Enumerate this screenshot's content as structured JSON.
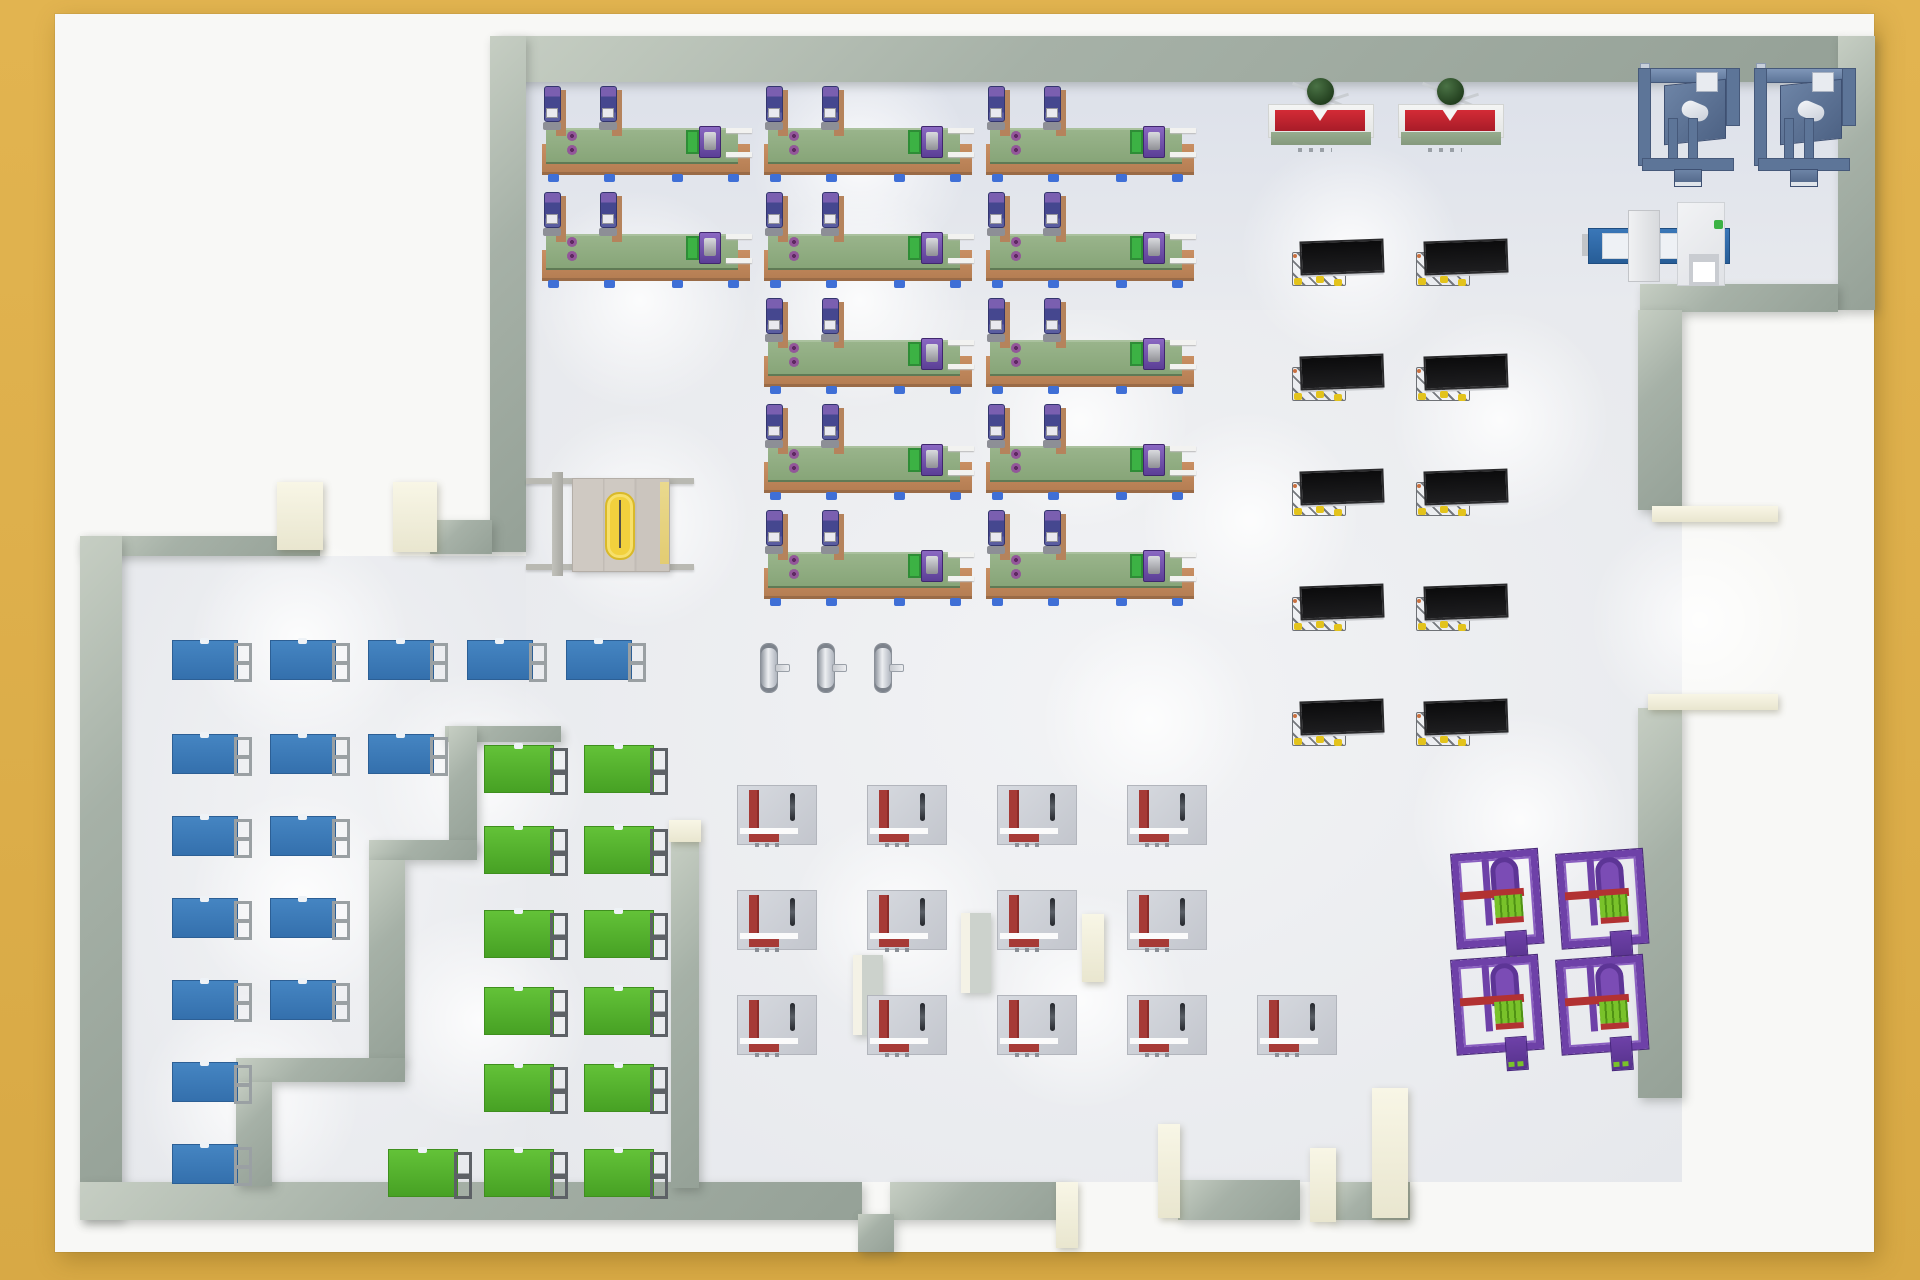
{
  "scene": {
    "description": "Top-down 3D render of a factory floor plan",
    "background_color": "#dcae4b",
    "page_color": "#f8f8f6",
    "floor_color": "#e9ebef",
    "wall_color": "#a6b1a7",
    "pillar_color": "#f0eedb"
  },
  "colors": {
    "conveyor_base": "#c0885c",
    "conveyor_belt": "#8fac80",
    "robot_purple": "#6a55a5",
    "desk_blue": "#3979b7",
    "desk_green": "#54b12d",
    "bench_gray": "#cdd0d6",
    "bench_red": "#a63a36",
    "monitor_black": "#161616",
    "monitor_yellow": "#e3c31c",
    "cell_purple": "#6e41a8",
    "cell_green": "#79c22a",
    "balancer_red": "#c32531",
    "sphere_green": "#2e4d2a",
    "gantry_steel": "#5d7598",
    "cmm_blue": "#2e69a9",
    "portal_yellow": "#f2d13d",
    "cylinder_silver": "#c8ccd3"
  },
  "floor_rects": [
    [
      526,
      82,
      1312,
      228
    ],
    [
      526,
      310,
      1156,
      872
    ],
    [
      122,
      556,
      404,
      626
    ]
  ],
  "lights": [
    [
      640,
      300
    ],
    [
      860,
      300
    ],
    [
      640,
      520
    ],
    [
      1080,
      420
    ],
    [
      300,
      640
    ],
    [
      480,
      780
    ],
    [
      300,
      900
    ],
    [
      480,
      1020
    ],
    [
      860,
      160
    ],
    [
      1250,
      520
    ],
    [
      1150,
      720
    ],
    [
      900,
      920
    ],
    [
      1500,
      420
    ],
    [
      1520,
      820
    ],
    [
      1700,
      620
    ],
    [
      1080,
      1000
    ],
    [
      250,
      1100
    ],
    [
      1350,
      250
    ]
  ],
  "walls": [
    [
      497,
      36,
      1341,
      46
    ],
    [
      1838,
      36,
      37,
      274
    ],
    [
      1640,
      284,
      198,
      28
    ],
    [
      490,
      36,
      36,
      516
    ],
    [
      430,
      520,
      62,
      34
    ],
    [
      80,
      536,
      240,
      20
    ],
    [
      80,
      536,
      42,
      684
    ],
    [
      80,
      1182,
      782,
      38
    ],
    [
      890,
      1182,
      176,
      38
    ],
    [
      1178,
      1180,
      122,
      40
    ],
    [
      1332,
      1182,
      78,
      38
    ],
    [
      858,
      1214,
      36,
      38
    ],
    [
      1638,
      310,
      44,
      200
    ],
    [
      1638,
      708,
      44,
      390
    ],
    [
      445,
      726,
      116,
      16
    ],
    [
      449,
      726,
      28,
      124
    ],
    [
      369,
      840,
      108,
      20
    ],
    [
      369,
      860,
      36,
      202
    ],
    [
      236,
      1058,
      169,
      24
    ],
    [
      236,
      1082,
      36,
      104
    ],
    [
      671,
      840,
      28,
      348
    ]
  ],
  "cream_blocks": [
    [
      277,
      482,
      46,
      68
    ],
    [
      393,
      482,
      44,
      70
    ],
    [
      1652,
      506,
      126,
      16
    ],
    [
      1648,
      694,
      130,
      16
    ],
    [
      669,
      820,
      32,
      22
    ],
    [
      1372,
      1088,
      36,
      130
    ],
    [
      1158,
      1124,
      22,
      94
    ],
    [
      1310,
      1148,
      26,
      74
    ],
    [
      1056,
      1182,
      22,
      66
    ],
    [
      1082,
      914,
      22,
      68
    ]
  ],
  "wall_stubs": [
    [
      853,
      955,
      30,
      80
    ],
    [
      961,
      913,
      30,
      80
    ]
  ],
  "equipment": {
    "conveyor_lines": {
      "unit_width": 212,
      "unit_height": 104,
      "robot_offsets": [
        2,
        58
      ],
      "rows": [
        {
          "belt_y": 128,
          "xs": [
            540,
            762,
            984
          ]
        },
        {
          "belt_y": 234,
          "xs": [
            540,
            762,
            984
          ]
        },
        {
          "belt_y": 340,
          "xs": [
            762,
            984
          ]
        },
        {
          "belt_y": 446,
          "xs": [
            762,
            984
          ]
        },
        {
          "belt_y": 552,
          "xs": [
            762,
            984
          ]
        }
      ]
    },
    "blue_desks": {
      "rows": [
        {
          "y": 640,
          "xs": [
            172,
            270,
            368,
            467,
            566
          ]
        },
        {
          "y": 734,
          "xs": [
            172,
            270,
            368
          ]
        },
        {
          "y": 816,
          "xs": [
            172,
            270
          ]
        },
        {
          "y": 898,
          "xs": [
            172,
            270
          ]
        },
        {
          "y": 980,
          "xs": [
            172,
            270
          ]
        },
        {
          "y": 1062,
          "xs": [
            172
          ]
        },
        {
          "y": 1144,
          "xs": [
            172
          ]
        }
      ]
    },
    "green_desks": {
      "rows": [
        {
          "y": 745,
          "xs": [
            484,
            584
          ]
        },
        {
          "y": 826,
          "xs": [
            484,
            584
          ]
        },
        {
          "y": 910,
          "xs": [
            484,
            584
          ]
        },
        {
          "y": 987,
          "xs": [
            484,
            584
          ]
        },
        {
          "y": 1064,
          "xs": [
            484,
            584
          ]
        },
        {
          "y": 1149,
          "xs": [
            388,
            484,
            584
          ]
        }
      ]
    },
    "gray_benches": {
      "rows": [
        {
          "y": 785,
          "xs": [
            737,
            867,
            997,
            1127
          ]
        },
        {
          "y": 890,
          "xs": [
            737,
            867,
            997,
            1127
          ]
        },
        {
          "y": 995,
          "xs": [
            737,
            867,
            997,
            1127,
            1257
          ]
        }
      ]
    },
    "monitor_stations": {
      "rows": [
        {
          "y": 240,
          "xs": [
            1292,
            1416
          ]
        },
        {
          "y": 355,
          "xs": [
            1292,
            1416
          ]
        },
        {
          "y": 470,
          "xs": [
            1292,
            1416
          ]
        },
        {
          "y": 585,
          "xs": [
            1292,
            1416
          ]
        },
        {
          "y": 700,
          "xs": [
            1292,
            1416
          ]
        }
      ]
    },
    "purple_cells": {
      "positions": [
        [
          1455,
          852
        ],
        [
          1560,
          852
        ],
        [
          1455,
          958
        ],
        [
          1560,
          958
        ]
      ]
    },
    "balancing_tables": {
      "positions": [
        [
          1268,
          76
        ],
        [
          1398,
          76
        ]
      ]
    },
    "steel_gantries": {
      "positions": [
        [
          1638,
          52
        ],
        [
          1754,
          52
        ]
      ]
    },
    "cmm_machine": {
      "x": 1588,
      "y": 202
    },
    "gas_cylinders": {
      "positions": [
        [
          760,
          643
        ],
        [
          817,
          643
        ],
        [
          874,
          643
        ]
      ]
    },
    "safety_portal": {
      "x": 526,
      "y": 470
    }
  }
}
